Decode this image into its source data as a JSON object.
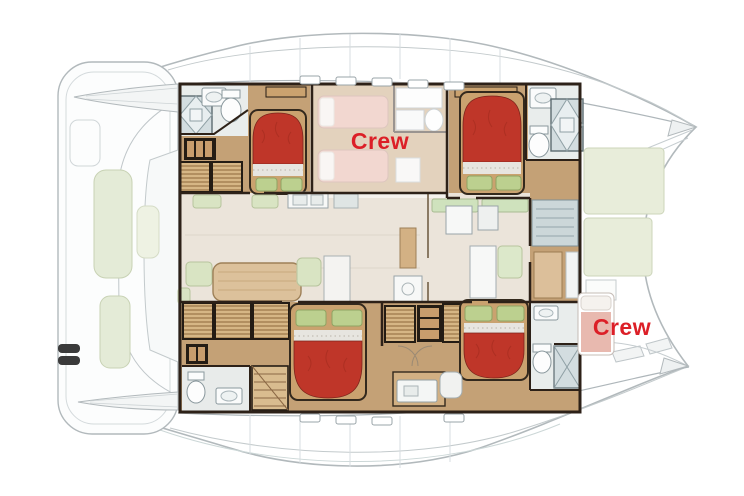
{
  "plan": {
    "kind": "catamaran-yacht-deck-plan",
    "orientation": "bow-left-stern-right"
  },
  "labels": {
    "crew_forward": "Crew",
    "crew_aft": "Crew"
  },
  "colors": {
    "background": "#ffffff",
    "crew_label_red": "#dc1f27",
    "bed_red": "#bf3629",
    "bed_sheet": "#e7e5e0",
    "pillow_green": "#bcd08f",
    "cabin_floor_tan": "#c4a176",
    "wall_dark_brown": "#2d2118",
    "wardrobe_wood": "#d6b685",
    "salon_floor_cream": "#ebe4da",
    "table_wood": "#dcc19b",
    "seat_green": "#d9e4c3",
    "aft_deck_green": "#e8edda",
    "bathroom_gray": "#d3dde0",
    "stairs_teal": "#ccd7d9",
    "crew_bed_faded_pink": "#e3ac9e",
    "hull_outline_gray": "#b2b9bc"
  },
  "areas": [
    "foredeck-lounge",
    "port-bow",
    "starboard-bow",
    "forward-cabin-top",
    "forward-crew-cabin",
    "aft-cabin-top",
    "salon",
    "forward-cabin-bottom",
    "aft-cabin-bottom",
    "stairwell",
    "aft-deck",
    "aft-crew-berth"
  ]
}
